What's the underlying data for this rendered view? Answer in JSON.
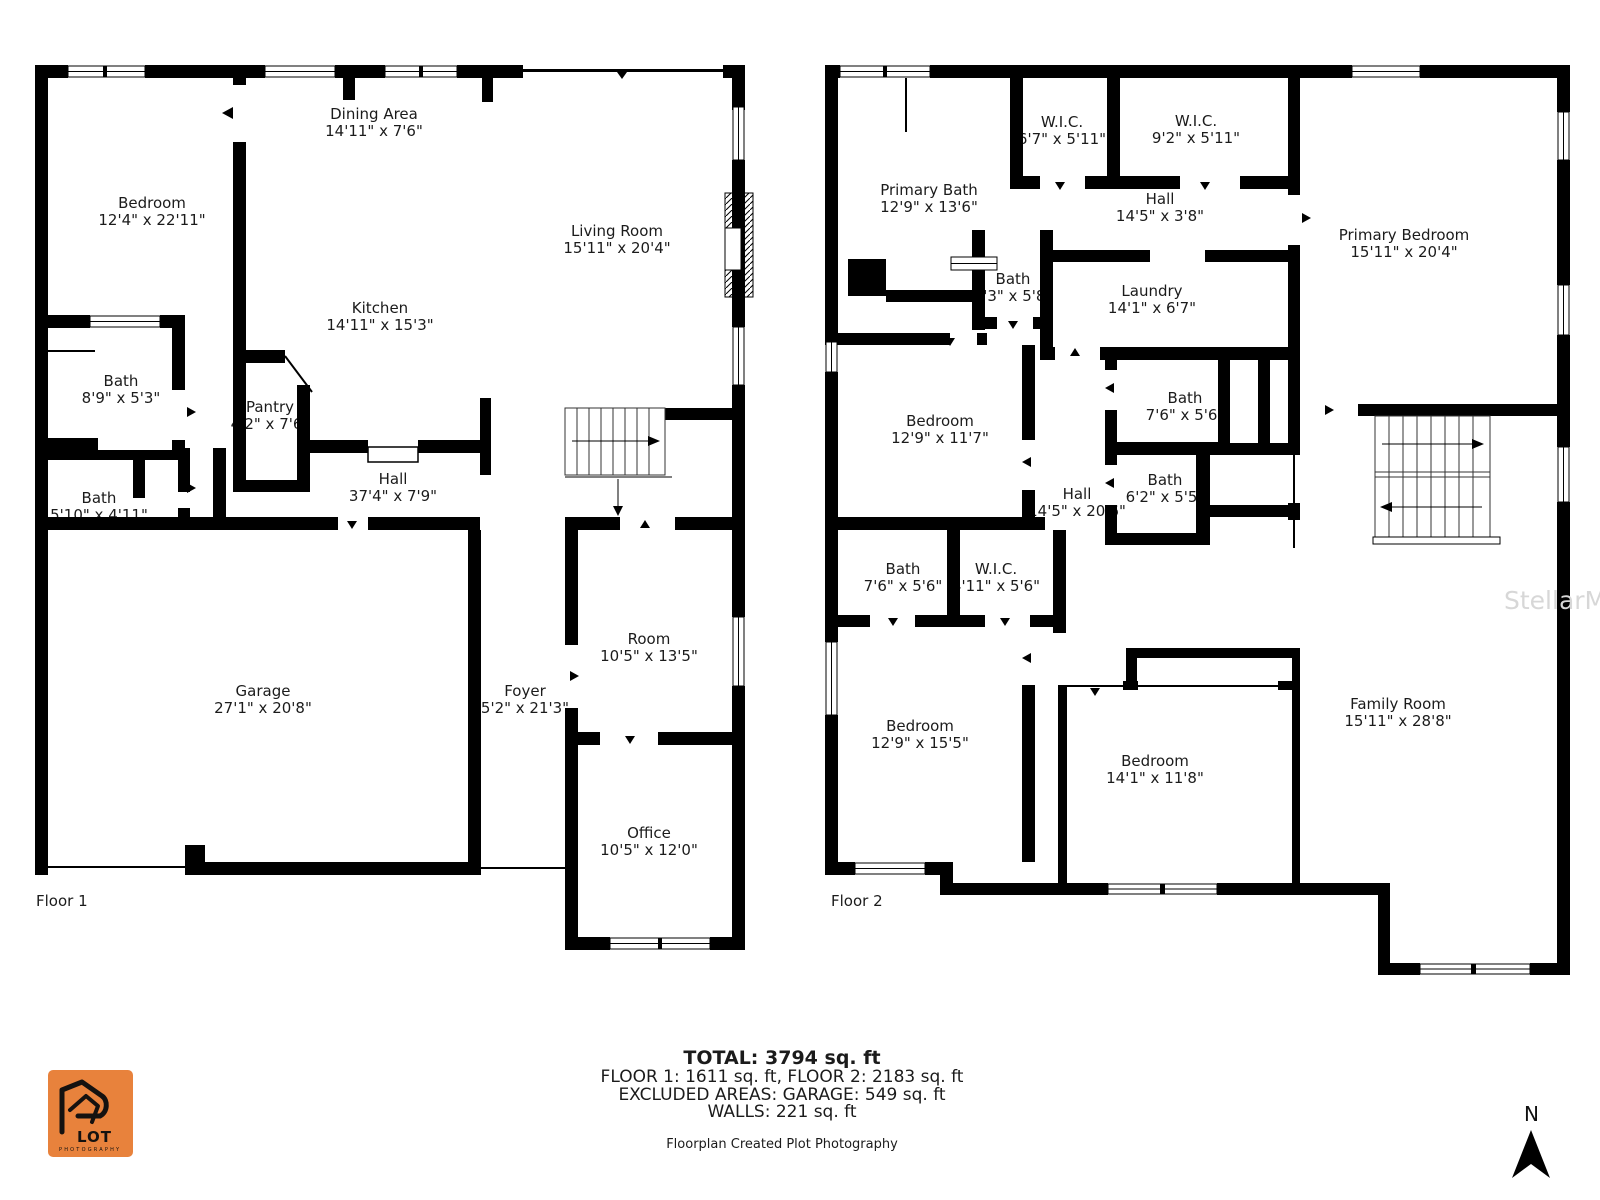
{
  "title": "Floorplan",
  "colors": {
    "wall": "#000000",
    "logo_orange": "#E8823C",
    "watermark_gray": "#d7d7d7"
  },
  "floor1": {
    "label": "Floor 1",
    "rooms": [
      {
        "name": "Bedroom",
        "dims": "12'4\" x 22'11\""
      },
      {
        "name": "Dining Area",
        "dims": "14'11\" x 7'6\""
      },
      {
        "name": "Living Room",
        "dims": "15'11\" x 20'4\""
      },
      {
        "name": "Kitchen",
        "dims": "14'11\" x 15'3\""
      },
      {
        "name": "Bath",
        "dims": "8'9\" x 5'3\""
      },
      {
        "name": "Pantry",
        "dims": "4'2\" x 7'6\""
      },
      {
        "name": "Bath",
        "dims": "5'10\" x 4'11\""
      },
      {
        "name": "Hall",
        "dims": "37'4\" x 7'9\""
      },
      {
        "name": "Garage",
        "dims": "27'1\" x 20'8\""
      },
      {
        "name": "Foyer",
        "dims": "5'2\" x 21'3\""
      },
      {
        "name": "Room",
        "dims": "10'5\" x 13'5\""
      },
      {
        "name": "Office",
        "dims": "10'5\" x 12'0\""
      }
    ]
  },
  "floor2": {
    "label": "Floor 2",
    "rooms": [
      {
        "name": "W.I.C.",
        "dims": "6'7\" x 5'11\""
      },
      {
        "name": "W.I.C.",
        "dims": "9'2\" x 5'11\""
      },
      {
        "name": "Primary Bath",
        "dims": "12'9\" x 13'6\""
      },
      {
        "name": "Hall",
        "dims": "14'5\" x 3'8\""
      },
      {
        "name": "Primary Bedroom",
        "dims": "15'11\" x 20'4\""
      },
      {
        "name": "Bath",
        "dims": "5'3\" x 5'8\""
      },
      {
        "name": "Laundry",
        "dims": "14'1\" x 6'7\""
      },
      {
        "name": "Bath",
        "dims": "7'6\" x 5'6\""
      },
      {
        "name": "Bedroom",
        "dims": "12'9\" x 11'7\""
      },
      {
        "name": "Bath",
        "dims": "6'2\" x 5'5\""
      },
      {
        "name": "Hall",
        "dims": "14'5\" x 20'6\""
      },
      {
        "name": "Bath",
        "dims": "7'6\" x 5'6\""
      },
      {
        "name": "W.I.C.",
        "dims": "4'11\" x 5'6\""
      },
      {
        "name": "Bedroom",
        "dims": "12'9\" x 15'5\""
      },
      {
        "name": "Bedroom",
        "dims": "14'1\" x 11'8\""
      },
      {
        "name": "Family Room",
        "dims": "15'11\" x 28'8\""
      }
    ]
  },
  "summary": {
    "total": "TOTAL: 3794 sq. ft",
    "floors": "FLOOR 1: 1611 sq. ft, FLOOR 2: 2183 sq. ft",
    "excluded": "EXCLUDED AREAS: GARAGE: 549 sq. ft",
    "walls": "WALLS: 221 sq. ft",
    "credit": "Floorplan Created Plot Photography"
  },
  "logo": {
    "wordmark": "LOT",
    "subtitle": "PHOTOGRAPHY"
  },
  "compass": {
    "label": "N"
  },
  "watermark": {
    "text": "StellarMLS"
  }
}
